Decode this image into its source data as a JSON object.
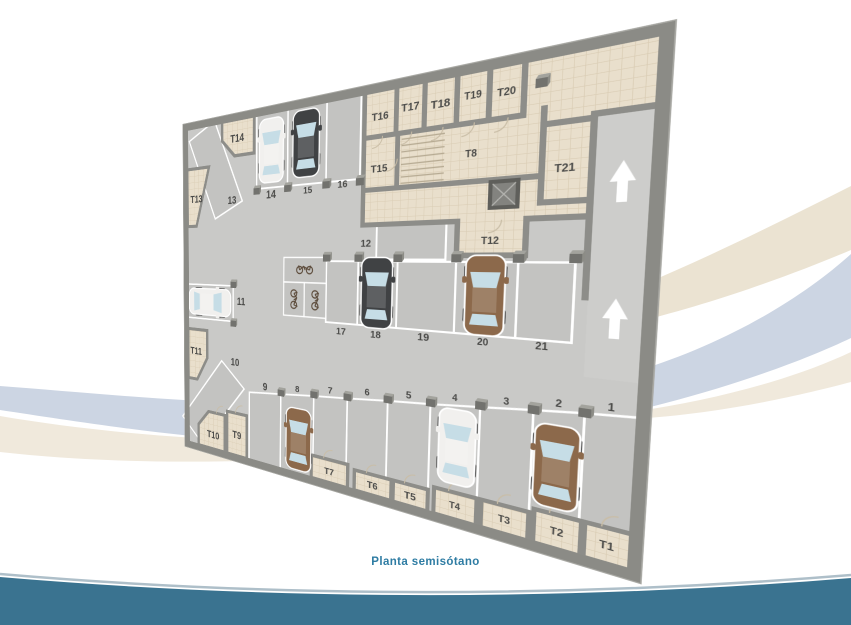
{
  "caption": "Planta semisótano",
  "labels": {
    "storage": [
      "T1",
      "T2",
      "T3",
      "T4",
      "T5",
      "T6",
      "T7",
      "T8",
      "T9",
      "T10",
      "T11",
      "T12",
      "T13",
      "T14",
      "T15",
      "T16",
      "T17",
      "T18",
      "T19",
      "T20",
      "T21"
    ],
    "parking": [
      "1",
      "2",
      "3",
      "4",
      "5",
      "6",
      "7",
      "8",
      "9",
      "10",
      "11",
      "12",
      "13",
      "14",
      "15",
      "16",
      "17",
      "18",
      "19",
      "20",
      "21"
    ]
  },
  "colors": {
    "accent_teal": "#3a7390",
    "caption_text": "#2e7ca3",
    "car_white": "#f1f0ee",
    "car_dark": "#404244",
    "car_brown": "#8c694b",
    "swoosh_beige": "#ebe3d2",
    "swoosh_blue": "#ccd5e3",
    "swoosh_cream": "#f0e9dc",
    "label_text": "#4a4a48"
  }
}
